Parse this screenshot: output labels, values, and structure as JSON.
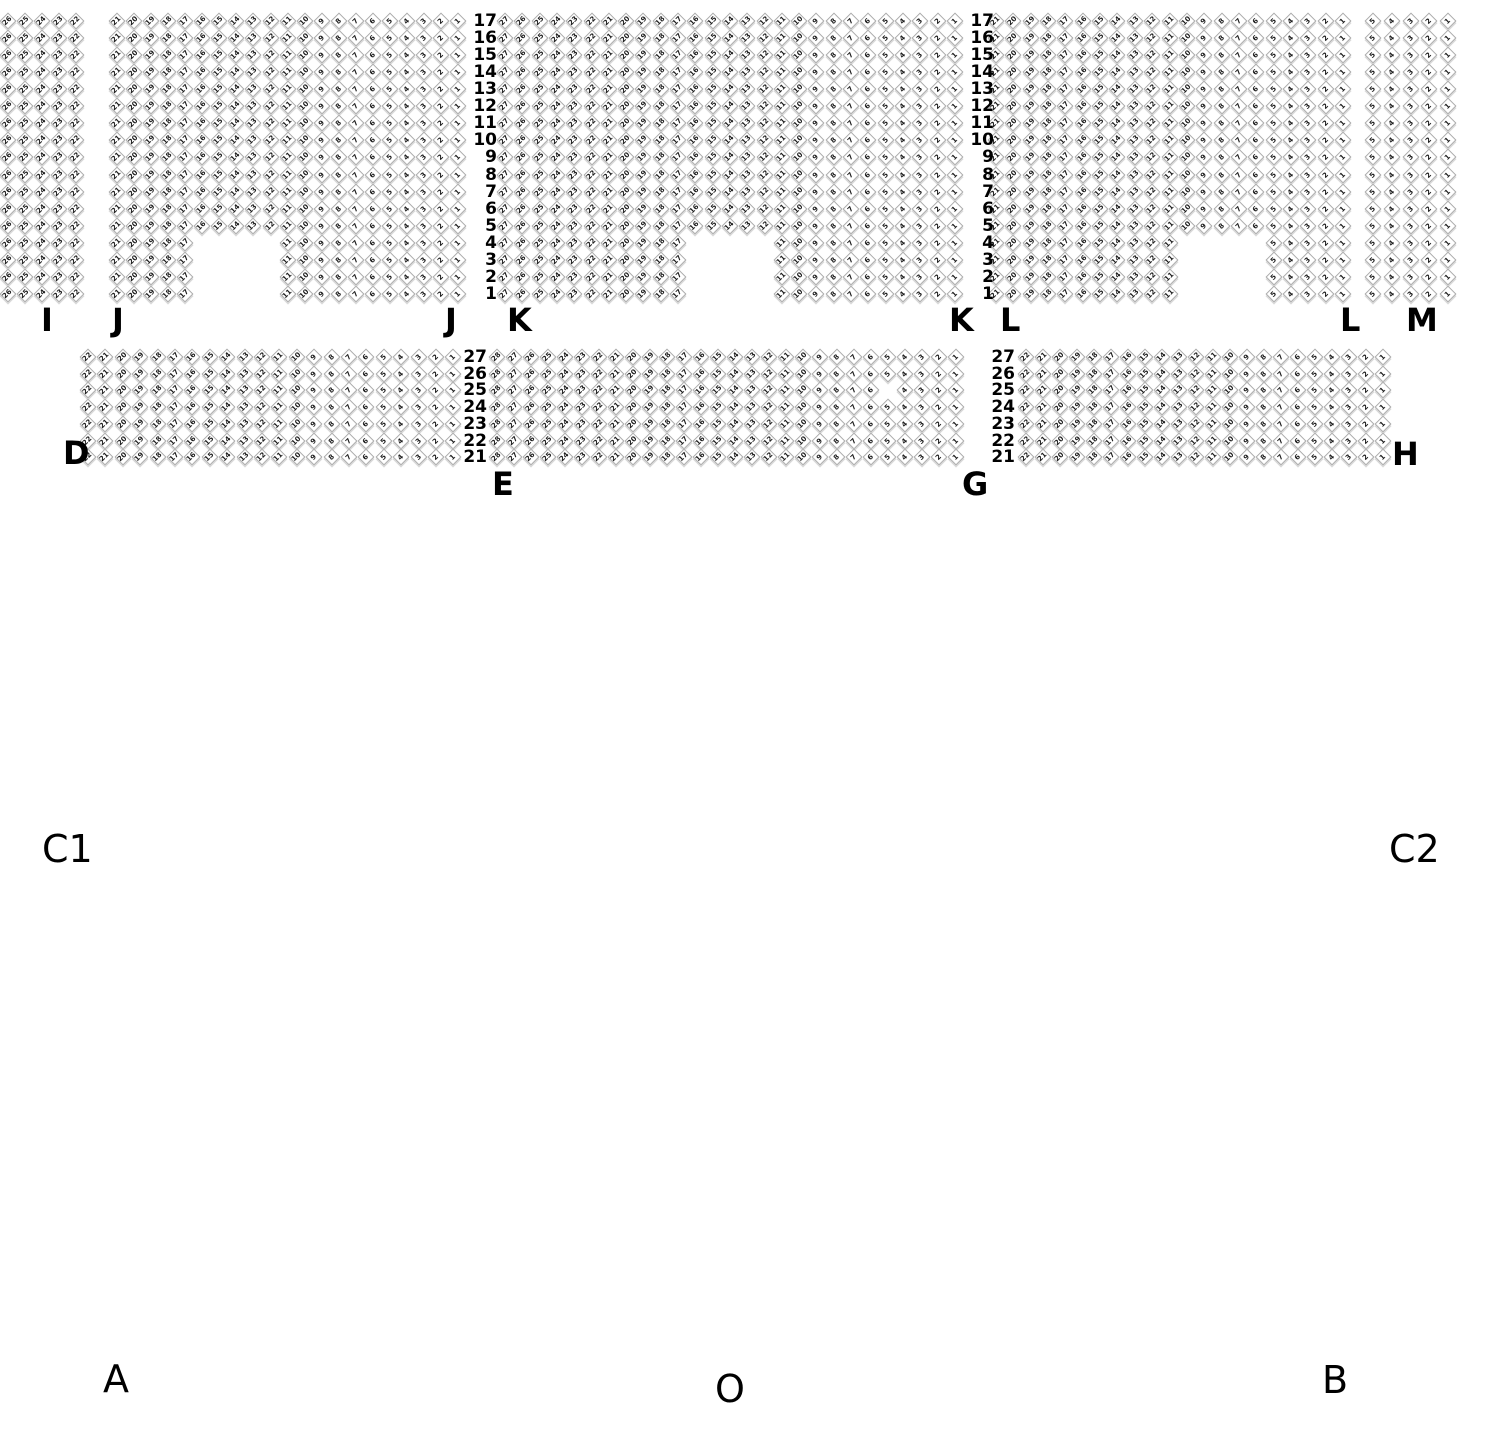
{
  "palette": {
    "background": "#ffffff",
    "seat_outline": "#ababab",
    "seat_shadow": "#d9d9d9",
    "seat_number_color": "#1c1c1c",
    "label_color": "#000000"
  },
  "seat_map": {
    "areas": {
      "top": {
        "y_first_row": 13,
        "row_pitch": 17.06,
        "row_start": 17,
        "row_end": 1
      },
      "mid": {
        "y_first_row": 349,
        "row_pitch": 16.7,
        "row_start": 27,
        "row_end": 21
      }
    },
    "blocks": [
      {
        "id": "I",
        "area": "top",
        "first_col_center_x": 8,
        "col_pitch": 17.0,
        "cols": 5,
        "leftmost_seat_number": 26
      },
      {
        "id": "J",
        "area": "top",
        "first_col_center_x": 117,
        "col_pitch": 17.06,
        "cols": 21,
        "leftmost_seat_number": 21,
        "notch": {
          "rows_from": 1,
          "rows_to": 4,
          "cols_from": 6,
          "cols_to": 10
        }
      },
      {
        "id": "K",
        "area": "top",
        "first_col_center_x": 505,
        "col_pitch": 17.3,
        "cols": 27,
        "leftmost_seat_number": 27,
        "notch": {
          "rows_from": 1,
          "rows_to": 4,
          "cols_from": 12,
          "cols_to": 16
        }
      },
      {
        "id": "L",
        "area": "top",
        "first_col_center_x": 996,
        "col_pitch": 17.35,
        "cols": 21,
        "leftmost_seat_number": 21,
        "notch": {
          "rows_from": 1,
          "rows_to": 4,
          "cols_from": 12,
          "cols_to": 16
        }
      },
      {
        "id": "M",
        "area": "top",
        "first_col_center_x": 1373,
        "col_pitch": 18.75,
        "cols": 5,
        "leftmost_seat_number": 5
      },
      {
        "id": "D",
        "area": "mid",
        "first_col_center_x": 88,
        "col_pitch": 17.4,
        "cols": 22,
        "leftmost_seat_number": 22
      },
      {
        "id": "E",
        "area": "mid",
        "first_col_center_x": 497,
        "col_pitch": 17.0,
        "cols": 28,
        "leftmost_seat_number": 28,
        "missing": [
          {
            "row": 25,
            "col": 24
          }
        ]
      },
      {
        "id": "H",
        "area": "mid",
        "first_col_center_x": 1026,
        "col_pitch": 17.0,
        "cols": 22,
        "leftmost_seat_number": 22
      }
    ],
    "row_number_columns": [
      {
        "area": "top",
        "right_x": 497
      },
      {
        "area": "top",
        "right_x": 994
      },
      {
        "area": "mid",
        "right_x": 487
      },
      {
        "area": "mid",
        "right_x": 1015
      }
    ],
    "labels": [
      {
        "text": "I",
        "x": 41,
        "y": 304,
        "style": "section"
      },
      {
        "text": "J",
        "x": 112,
        "y": 304,
        "style": "section"
      },
      {
        "text": "J",
        "x": 445,
        "y": 304,
        "style": "section"
      },
      {
        "text": "K",
        "x": 507,
        "y": 304,
        "style": "section"
      },
      {
        "text": "K",
        "x": 949,
        "y": 304,
        "style": "section"
      },
      {
        "text": "L",
        "x": 1000,
        "y": 304,
        "style": "section"
      },
      {
        "text": "L",
        "x": 1340,
        "y": 304,
        "style": "section"
      },
      {
        "text": "M",
        "x": 1406,
        "y": 304,
        "style": "section"
      },
      {
        "text": "D",
        "x": 63,
        "y": 437,
        "style": "section"
      },
      {
        "text": "E",
        "x": 492,
        "y": 468,
        "style": "section"
      },
      {
        "text": "G",
        "x": 962,
        "y": 468,
        "style": "section"
      },
      {
        "text": "H",
        "x": 1392,
        "y": 438,
        "style": "section"
      },
      {
        "text": "C1",
        "x": 42,
        "y": 830,
        "style": "zone"
      },
      {
        "text": "C2",
        "x": 1389,
        "y": 830,
        "style": "zone"
      },
      {
        "text": "A",
        "x": 103,
        "y": 1360,
        "style": "zone"
      },
      {
        "text": "O",
        "x": 715,
        "y": 1370,
        "style": "zone"
      },
      {
        "text": "B",
        "x": 1322,
        "y": 1361,
        "style": "zone"
      }
    ]
  }
}
